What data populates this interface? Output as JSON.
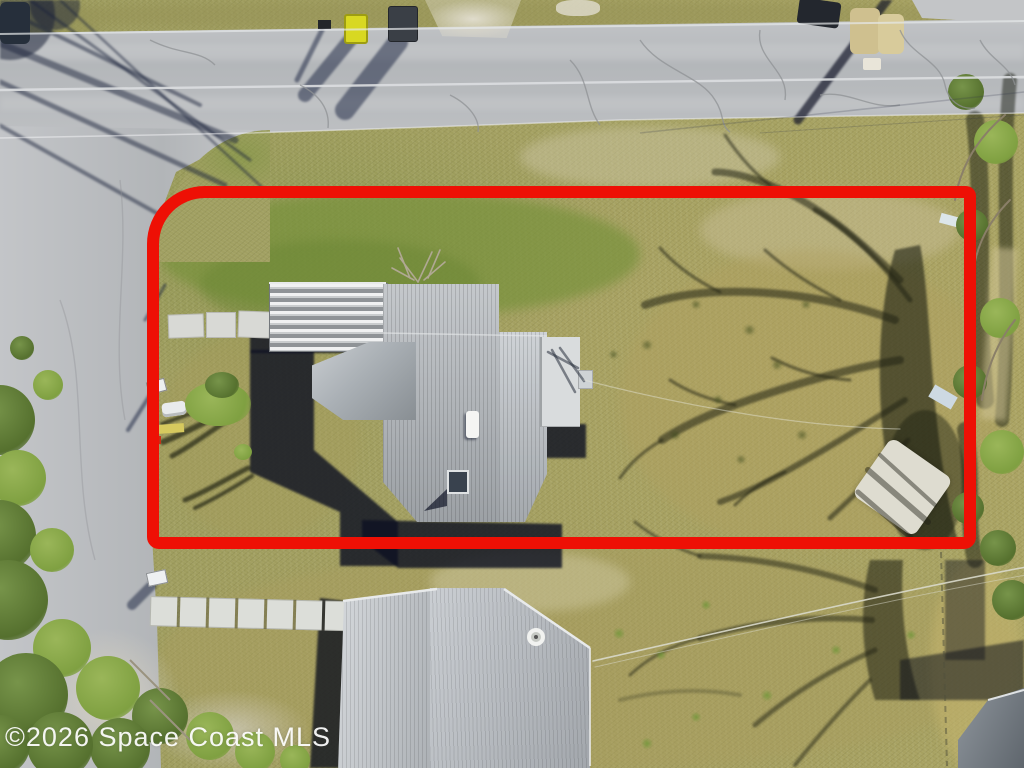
{
  "scene": {
    "description": "Aerial drone photo of a residential corner lot outlined in red, Space Coast MLS listing",
    "watermark": "©2026 Space Coast MLS",
    "elements": [
      "top-road",
      "left-road",
      "intersection",
      "main-house",
      "carport",
      "flat-roof",
      "bottom-house",
      "corner-roof",
      "tree-shadow",
      "trash-bins",
      "mailboxes",
      "walkways",
      "power-lines",
      "sand-patch",
      "bushes"
    ]
  },
  "boundary": {
    "color": "#ee1005",
    "stroke_width_px": 12,
    "shape": "rectangle with large rounded top-left corner"
  },
  "palette": {
    "grass_base": "#a3a061",
    "grass_green": "#7e9448",
    "grass_tan": "#b3a768",
    "road": "#b7babd",
    "road_line": "#dcdee0",
    "roof_shingle": "#aeb3b8",
    "roof_flat": "#d9dcdd",
    "carport_stripe_light": "#f0f1f2",
    "carport_stripe_dark": "#8f9397",
    "shadow_dark": "#10162e",
    "tree_shadow": "#23261a",
    "sand": "#d6d3c6",
    "bush_green": "#6b8a3a",
    "bin_yellow": "#d8d822",
    "boundary": "#ee1005"
  }
}
